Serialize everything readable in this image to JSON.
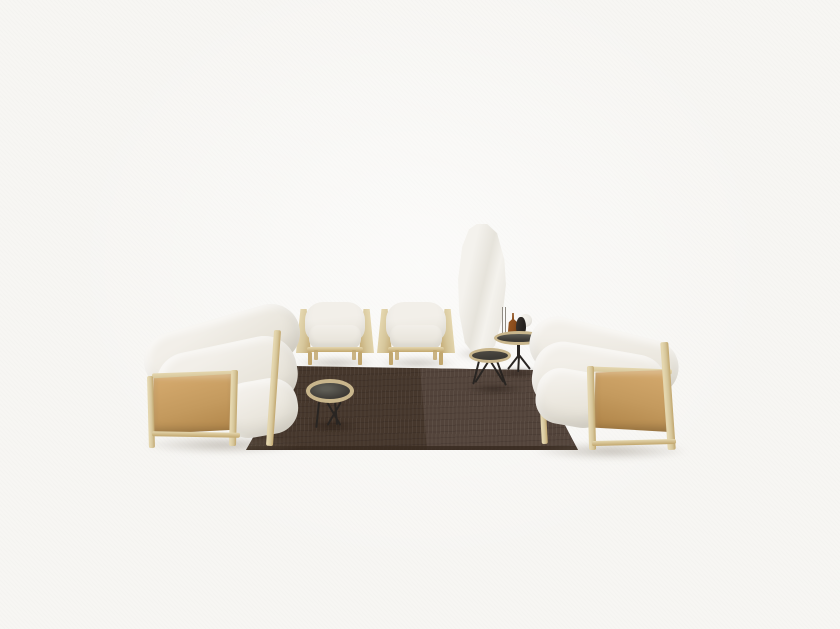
{
  "scene": {
    "alt": "Living room furniture set on a white studio background: two three-seater sofas with camel leather side panels and light wood frames, two matching armchairs, a dark brown two-tone rug, three round tray tables with black metal spider legs, a tall white sculptural floor vase, and small decor objects including an amber bottle, a black vase, glass stems and a white sphere",
    "items": [
      "left-sofa",
      "right-sofa",
      "armchair-left",
      "armchair-right",
      "tall-white-vase",
      "side-table-high",
      "side-table-low",
      "coffee-table",
      "rug",
      "glass-rods-decor",
      "amber-bottle-decor",
      "black-vase-decor",
      "white-sphere-decor"
    ]
  },
  "palette": {
    "background": "#f7f6f3",
    "cushion_light": "#f2efe9",
    "cushion_mid": "#e7e3d9",
    "cushion_dark": "#d6d1c5",
    "leather_light": "#d2a76b",
    "leather": "#c49a5e",
    "leather_dark": "#b1864a",
    "wood_light": "#e4d6ae",
    "wood": "#d6c69b",
    "wood_dark": "#c2a76e",
    "rug_left": "#46372c",
    "rug_right": "#53443b",
    "rug_edge": "#382b21",
    "tabletop_dark": "#3d3a35",
    "tabletop_sheen": "#5e5d55",
    "table_rim": "#c9b68c",
    "metal": "#292522",
    "bottle_amber": "#8a4c1c",
    "decor_dark": "#25211e",
    "vase_white": "#f4f2ed",
    "vase_shade": "#e6e3db",
    "sphere": "#eae8e2",
    "shadow": "rgba(125,115,100,0.40)",
    "rug_shadow": "rgba(22,13,7,0.45)"
  }
}
